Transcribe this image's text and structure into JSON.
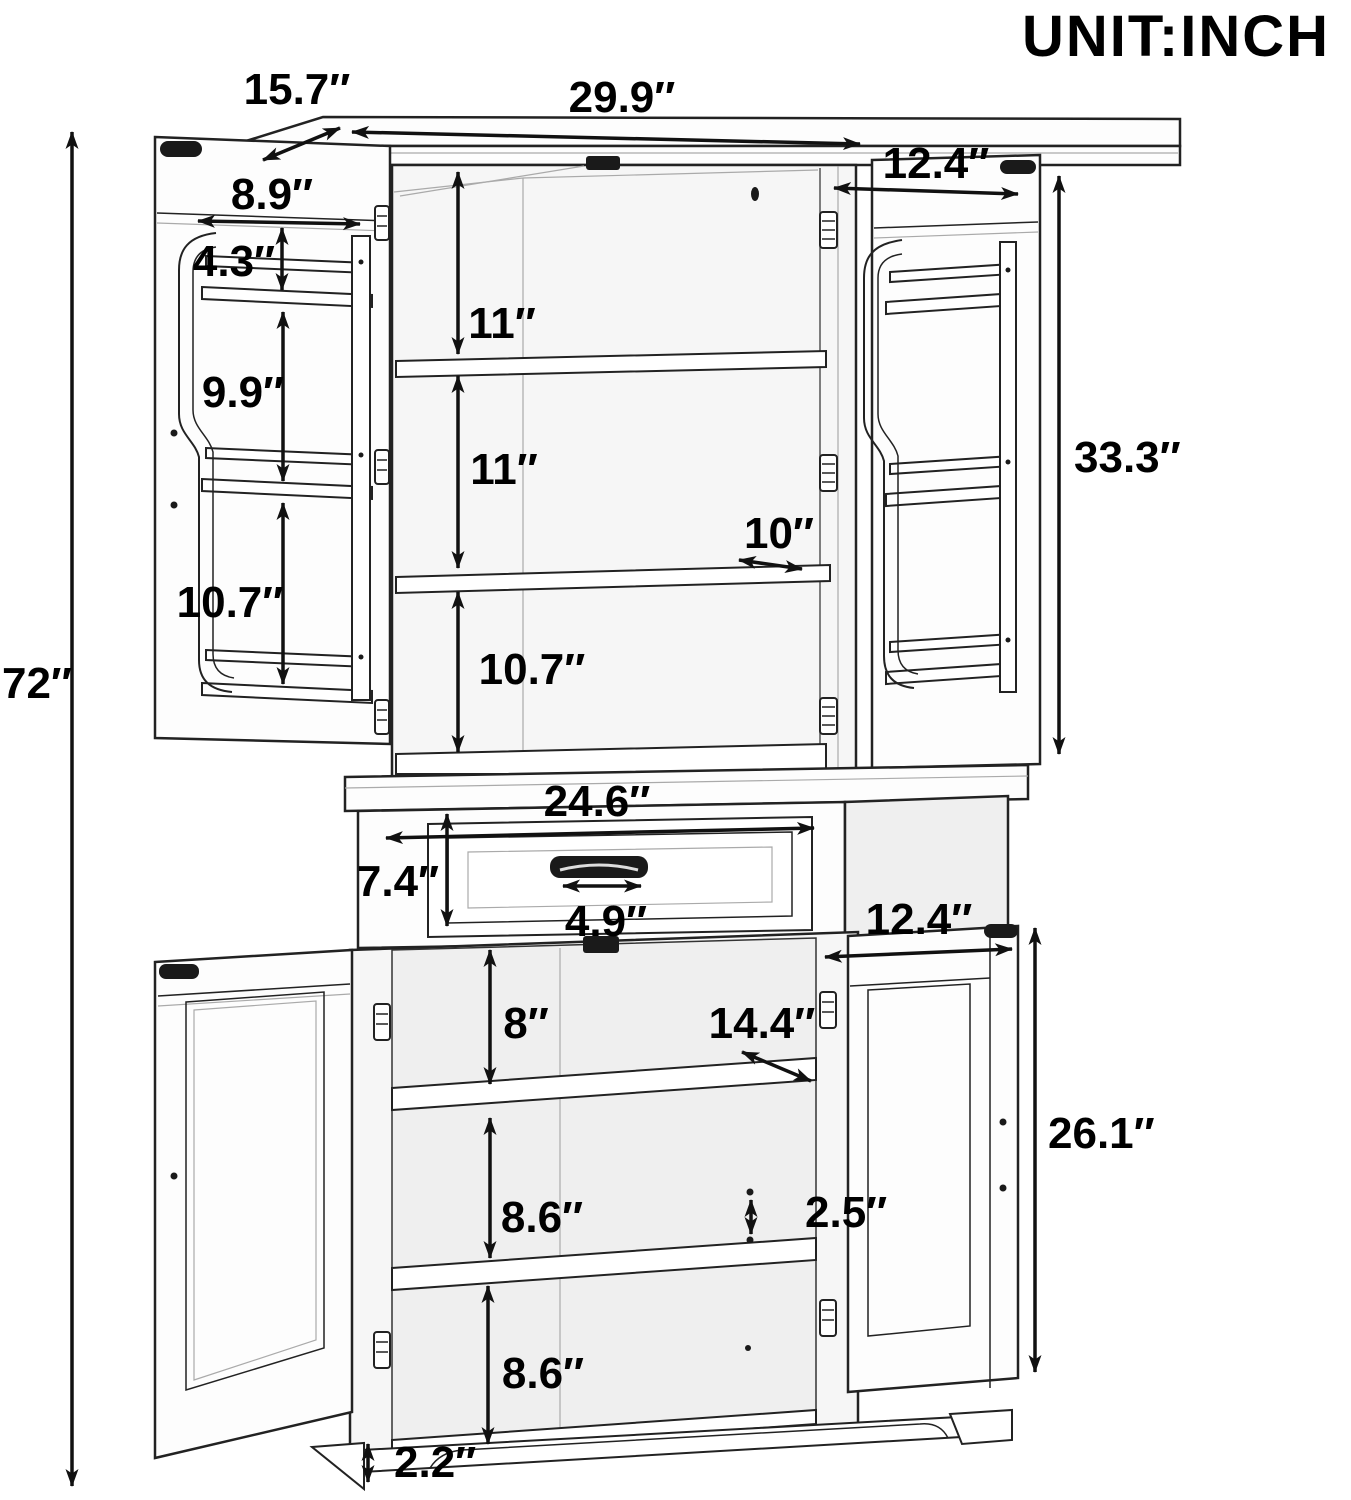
{
  "unit_label": "UNIT:INCH",
  "colors": {
    "line": "#1a1a1a",
    "text": "#000000",
    "background": "#ffffff",
    "interior_fill": "#f5f5f5"
  },
  "dimensions": {
    "overall": {
      "height": "72″",
      "top_width": "29.9″",
      "top_depth": "15.7″"
    },
    "upper_doors": {
      "door_width": "12.4″",
      "door_height": "33.3″",
      "rack_width": "8.9″",
      "rack_gap_top": "4.3″",
      "rack_gap_middle": "9.9″",
      "rack_gap_bottom": "10.7″"
    },
    "upper_interior": {
      "section_1": "11″",
      "section_2": "11″",
      "shelf_depth": "10″",
      "section_3": "10.7″"
    },
    "drawer": {
      "width": "24.6″",
      "height": "7.4″",
      "handle_width": "4.9″"
    },
    "lower_cabinet": {
      "door_width": "12.4″",
      "door_height": "26.1″",
      "section_1": "8″",
      "shelf_depth": "14.4″",
      "section_2": "8.6″",
      "shelf_hole_gap": "2.5″",
      "section_3": "8.6″",
      "base_height": "2.2″"
    }
  }
}
